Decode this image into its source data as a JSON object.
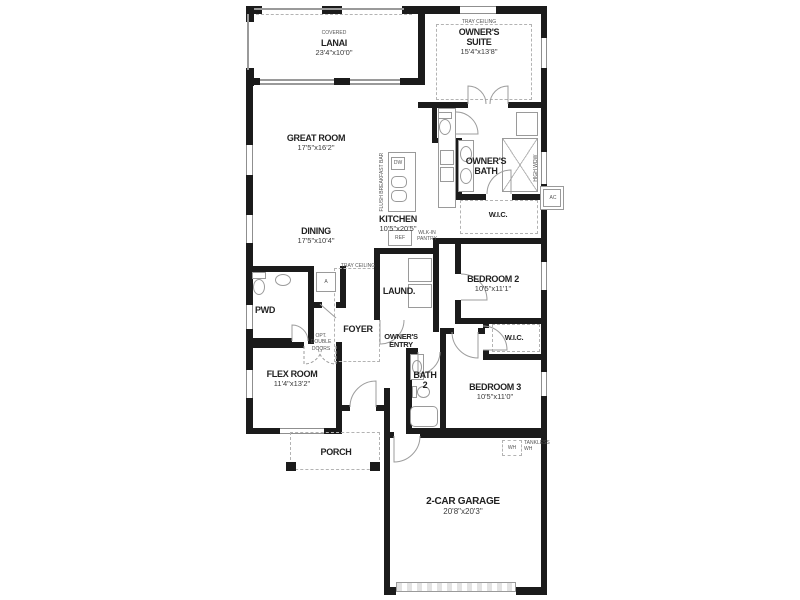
{
  "plan_title": "single-story home floor plan",
  "rooms": {
    "lanai": {
      "tag": "COVERED",
      "name": "LANAI",
      "dims": "23'4\"x10'0\""
    },
    "owners_suite": {
      "tag": "TRAY CEILING",
      "name": "OWNER'S SUITE",
      "dims": "15'4\"x13'8\""
    },
    "great_room": {
      "name": "GREAT ROOM",
      "dims": "17'5\"x16'2\""
    },
    "dining": {
      "name": "DINING",
      "dims": "17'5\"x10'4\""
    },
    "kitchen": {
      "name": "KITCHEN",
      "dims": "10'5\"x20'5\""
    },
    "owners_bath": {
      "name": "OWNER'S BATH"
    },
    "owners_wic": {
      "name": "W.I.C."
    },
    "laundry": {
      "name": "LAUND."
    },
    "foyer": {
      "tag": "TRAY CEILING",
      "name": "FOYER"
    },
    "owners_entry": {
      "name": "OWNER'S ENTRY"
    },
    "pwd": {
      "name": "PWD"
    },
    "bedroom2": {
      "name": "BEDROOM 2",
      "dims": "10'5\"x11'1\""
    },
    "bed2_wic": {
      "name": "W.I.C."
    },
    "bath2": {
      "name": "BATH 2"
    },
    "bedroom3": {
      "name": "BEDROOM 3",
      "dims": "10'5\"x11'0\""
    },
    "flex": {
      "name": "FLEX ROOM",
      "dims": "11'4\"x13'2\""
    },
    "porch": {
      "name": "PORCH"
    },
    "garage": {
      "name": "2-CAR GARAGE",
      "dims": "20'8\"x20'3\""
    }
  },
  "annotations": {
    "opt_double_doors": "OPT. DOUBLE DOORS",
    "flush_bar": "FLUSH BREAKFAST BAR",
    "ref": "REF",
    "dw": "DW",
    "pantry": "WLK-IN PANTRY",
    "tankless": "TANKLESS WH",
    "wh": "WH",
    "ac": "AC",
    "air_handler": "A",
    "high_window": "HIGH WDW"
  },
  "colors": {
    "wall": "#1b1b1b",
    "fixture_line": "#9a9a9a",
    "text": "#222222"
  }
}
